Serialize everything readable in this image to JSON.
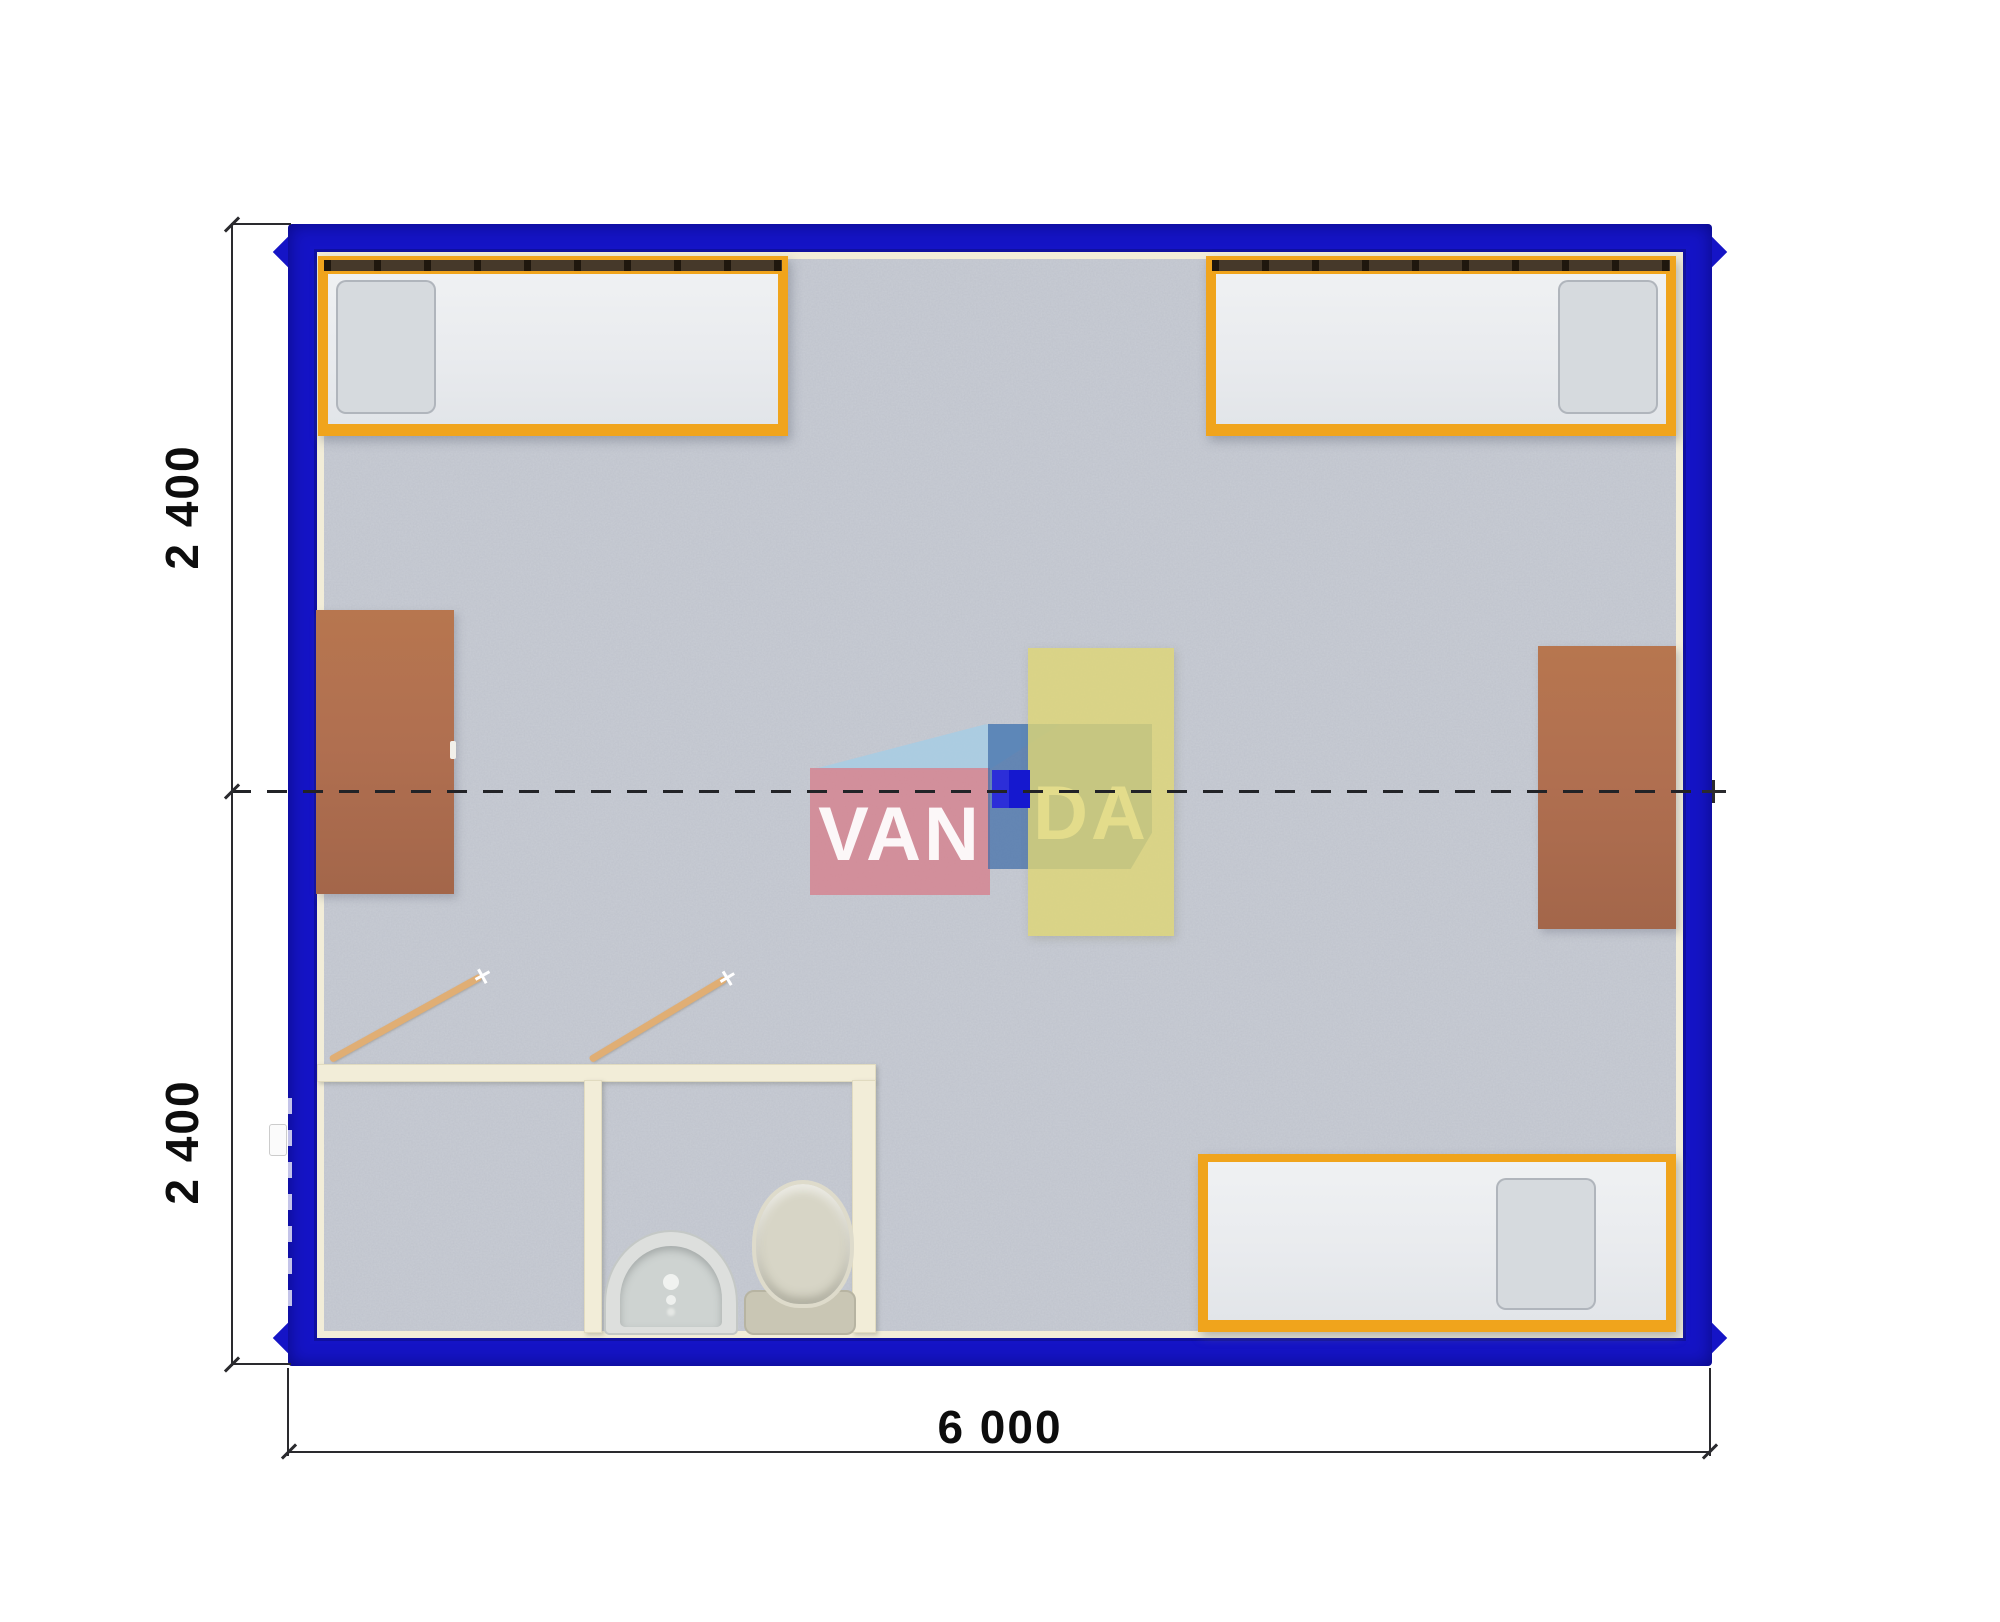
{
  "plan_annotations": {
    "side_upper_label": "2 400",
    "side_lower_label": "2 400",
    "bottom_width_label": "6 000"
  },
  "watermark": {
    "left_text": "VAN",
    "right_text": "DA"
  },
  "furniture_inventory": {
    "beds": 3,
    "desks": 2,
    "tables": 1,
    "toilets": 1,
    "washbasins": 1,
    "door_swings": 2
  },
  "colors": {
    "frame": "#1514c6",
    "wall": "#f2edd8",
    "floor": "#c9cdd5",
    "bed_frame": "#f0a41c",
    "mattress": "#eaedef",
    "pillow": "#d6dade",
    "bed_rail": "#46392a",
    "desk": "#b06f50",
    "table": "rgba(222,214,116,0.8)",
    "marker": "#1518cf",
    "door": "#e0ae74",
    "fixture": "#d7d5c6",
    "logo_pink": "rgba(214,127,140,0.78)",
    "logo_blue": "rgba(62,108,168,0.72)",
    "logo_sky": "rgba(167,205,228,0.85)",
    "dim": "#2a2a2e"
  }
}
